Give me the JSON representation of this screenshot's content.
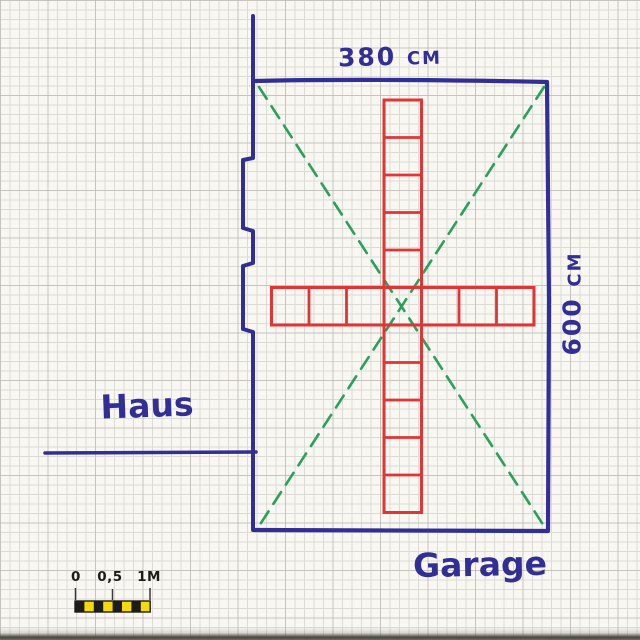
{
  "diagram_type": "hand-drawn floor plan sketch on graph paper",
  "garage": {
    "label": "Garage",
    "width_label": "380 cm",
    "depth_label": "600 cm"
  },
  "house": {
    "label": "Haus"
  },
  "tile_cross": {
    "horizontal_tiles": 7,
    "vertical_tiles": 11,
    "color": "#e23434"
  },
  "diagonals": {
    "count": 2,
    "style": "dashed",
    "color": "#2aa05a"
  },
  "scale_bar": {
    "labels": [
      "0",
      "0,5",
      "1M"
    ],
    "segments": 8,
    "segment_colors": [
      "#1c1c1a",
      "#f5d90a"
    ]
  },
  "colors": {
    "ink_blue": "#312e96",
    "tile_red": "#e23434",
    "diagonal_green": "#2aa05a",
    "scale_yellow": "#f5d90a",
    "scale_black": "#1c1c1a",
    "paper": "#f8f7f2",
    "grid_line": "#dddbd5"
  }
}
